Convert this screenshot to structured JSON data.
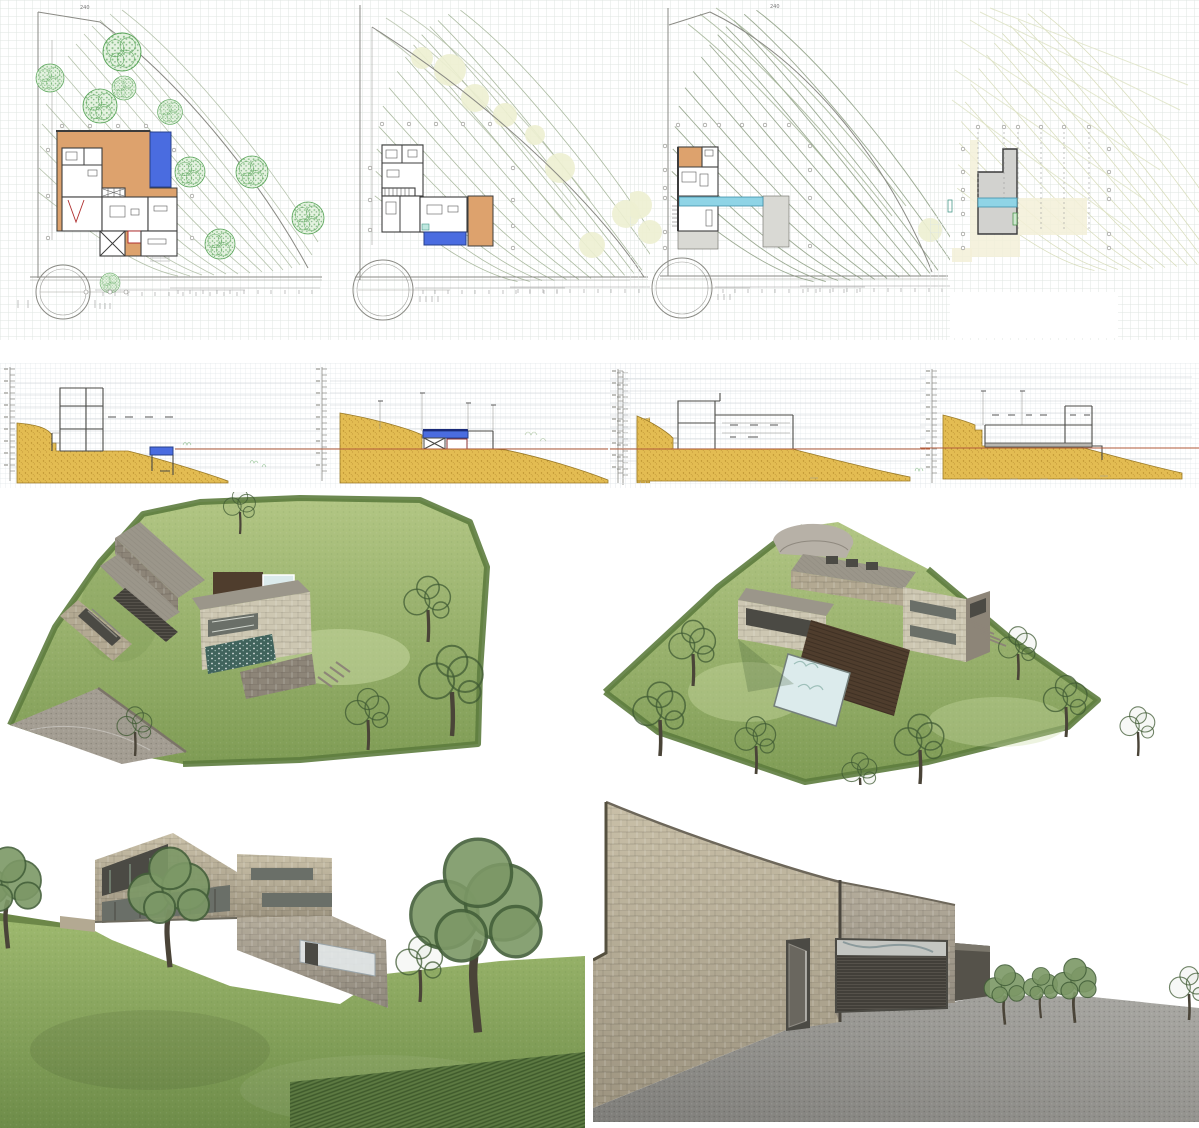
{
  "sheet": {
    "kind": "architectural-presentation-sheet",
    "rows": [
      {
        "name": "floor-plans",
        "panels": [
          {
            "id": "site-plan-upper-level",
            "features": [
              "orange-terrace",
              "blue-pool",
              "tree-symbols",
              "contour-lines",
              "turning-circle",
              "dimension-strings"
            ]
          },
          {
            "id": "site-plan-main-level",
            "features": [
              "room-layout",
              "blue-pool",
              "orange-patio",
              "contour-lines",
              "turning-circle"
            ]
          },
          {
            "id": "site-plan-lower-level",
            "features": [
              "orange-room",
              "cyan-pool-strip",
              "grey-decks",
              "contour-lines",
              "turning-circle"
            ]
          },
          {
            "id": "roof-plan",
            "features": [
              "grey-roof",
              "cyan-skylight-strip",
              "column-grid-dots",
              "faint-contours"
            ]
          }
        ]
      },
      {
        "name": "sections",
        "panels": [
          {
            "id": "section-a",
            "features": [
              "two-storey-volume",
              "blue-pool",
              "earth-hatch",
              "elevation-tick-scale"
            ]
          },
          {
            "id": "section-b",
            "features": [
              "buried-volume",
              "blue-roof-pool",
              "x-brace",
              "red-datum-line",
              "earth-hatch"
            ]
          },
          {
            "id": "section-c",
            "features": [
              "stepped-volumes",
              "red-datum-line",
              "earth-hatch"
            ]
          },
          {
            "id": "section-d",
            "features": [
              "long-low-volume",
              "red-datum-line",
              "earth-hatch"
            ]
          }
        ]
      },
      {
        "name": "aerial-renders",
        "panels": [
          {
            "id": "aerial-view-from-west",
            "features": [
              "green-hillside",
              "stone-volumes",
              "dark-pool",
              "skylights",
              "driveway"
            ]
          },
          {
            "id": "aerial-view-from-east",
            "features": [
              "triangular-plot",
              "stone-volumes",
              "light-pool",
              "timber-deck",
              "round-forecourt"
            ]
          }
        ]
      },
      {
        "name": "perspective-renders",
        "panels": [
          {
            "id": "garden-perspective",
            "features": [
              "stone-house",
              "large-openings",
              "lawn",
              "trees",
              "hedge-rows"
            ]
          },
          {
            "id": "entrance-wall-perspective",
            "features": [
              "curved-stone-wall",
              "entry-door",
              "garage-grille",
              "gravel-forecourt",
              "shrubs"
            ]
          }
        ]
      }
    ]
  },
  "labels": {
    "contour_240": "240"
  },
  "colors": {
    "grid": "#dfe6e2",
    "contour": "#9fb092",
    "contour-faint": "#d6dbb8",
    "boundary": "#8a8a84",
    "plan-line": "#3c3c3c",
    "terrace-orange": "#dda26d",
    "pool-blue": "#4a6ce0",
    "pool-cyan": "#8fd4e6",
    "tree-green": "#57a457",
    "tree-fill": "#e4f2e0",
    "faint-tree": "#edf0d2",
    "earth-yellow": "#e3bc52",
    "earth-dot": "#b98f2e",
    "datum-red": "#b05a3a",
    "section-line": "#4a4a46",
    "grass-light": "#b2c684",
    "grass-mid": "#8fa95f",
    "grass-dark": "#5d7c3e",
    "stone-tan": "#b3a992",
    "stone-light": "#cdc7b2",
    "roof-render": "#9b968a",
    "deck-brown": "#4f3d2d",
    "pool-render-dark": "#40635c",
    "pool-render-light": "#dcebec",
    "drive-gray": "#a39d92",
    "gravel-gray": "#8e8d89",
    "opening-dark": "#4b4a44"
  }
}
